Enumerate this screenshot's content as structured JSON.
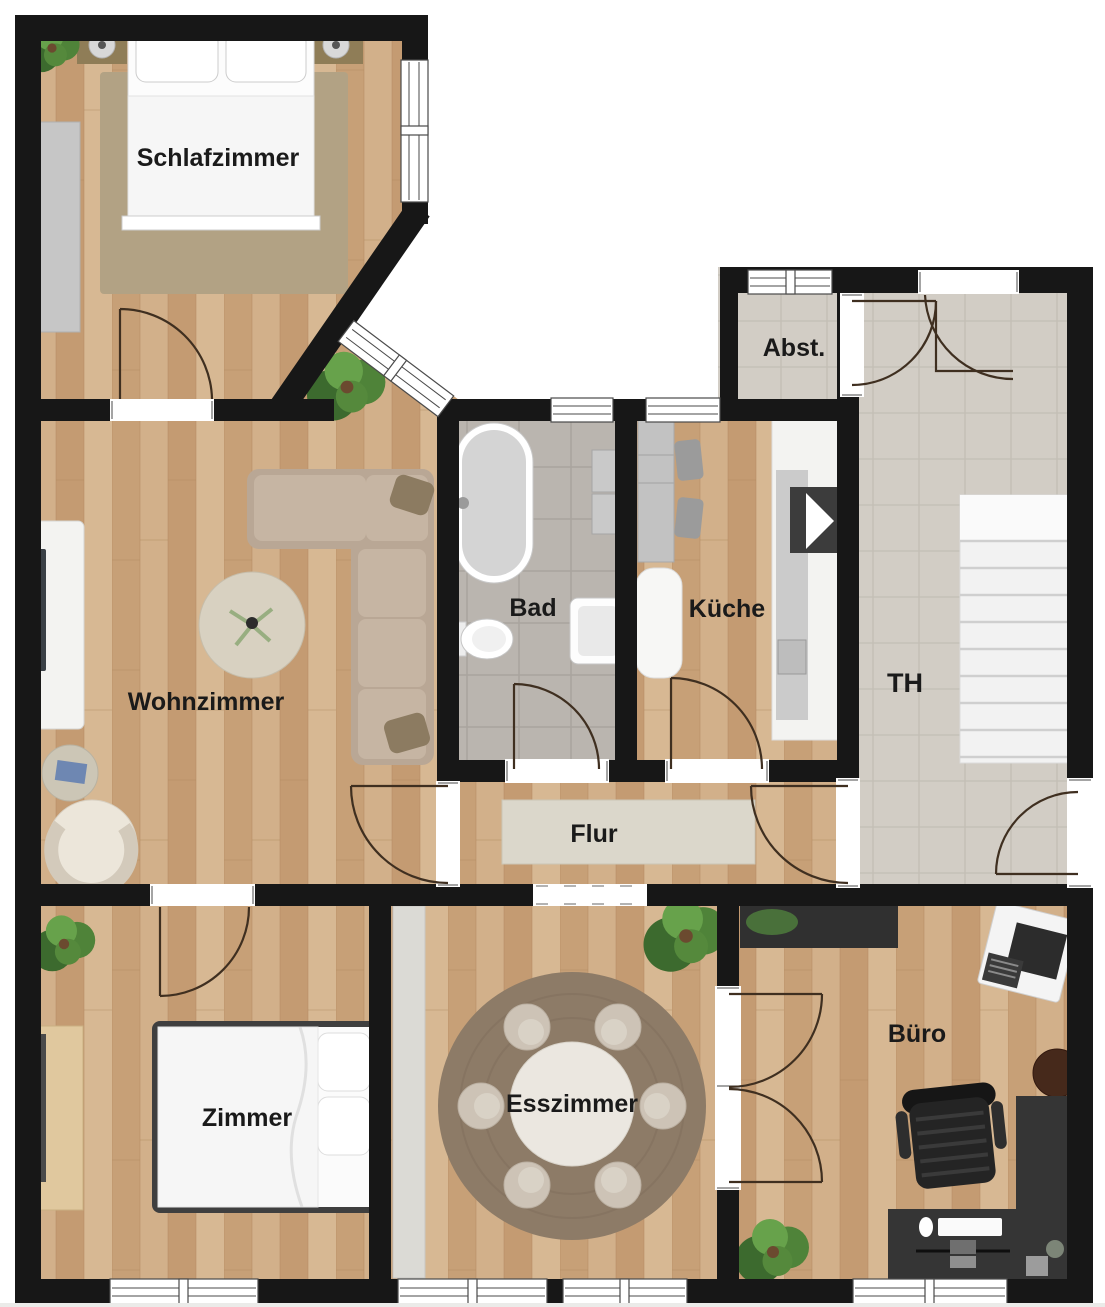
{
  "rooms": {
    "schlafzimmer": {
      "label": "Schlafzimmer"
    },
    "wohnzimmer": {
      "label": "Wohnzimmer"
    },
    "bad": {
      "label": "Bad"
    },
    "kueche": {
      "label": "Küche"
    },
    "abstellraum": {
      "label": "Abst."
    },
    "treppenhaus": {
      "label": "TH"
    },
    "flur": {
      "label": "Flur"
    },
    "zimmer": {
      "label": "Zimmer"
    },
    "esszimmer": {
      "label": "Esszimmer"
    },
    "buero": {
      "label": "Büro"
    }
  },
  "theme": {
    "wall": "#171717",
    "wood_base": "#cdaa82",
    "bath_tile": "#bab5af",
    "stair_tile": "#d2cdc5",
    "bedroom_rug": "#b2a284",
    "hall_rug": "#dbd7cb",
    "dining_rug": "#8d7b67",
    "sofa": "#b9a795",
    "dark_furniture": "#303030",
    "label_color": "#1a1a1a",
    "door_arc": "#3f2f20",
    "window_frame": "#4a4a4a"
  }
}
